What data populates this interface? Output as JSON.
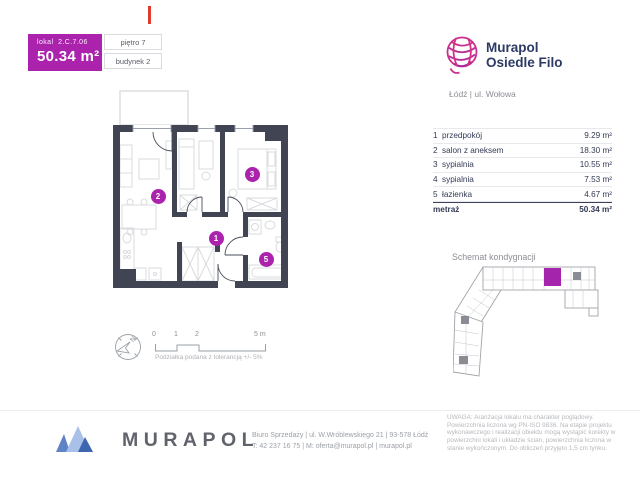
{
  "unit_card": {
    "label": "lokal",
    "number": "2.C.7.06",
    "area": "50.34 m²",
    "floor": "piętro 7",
    "building": "budynek 2"
  },
  "brand": {
    "line1": "Murapol",
    "line2": "Osiedle Filo",
    "location": "Łódź | ul. Wołowa"
  },
  "room_table": {
    "rows": [
      {
        "no": "1",
        "name": "przedpokój",
        "area": "9.29 m²"
      },
      {
        "no": "2",
        "name": "salon z aneksem",
        "area": "18.30 m²"
      },
      {
        "no": "3",
        "name": "sypialnia",
        "area": "10.55 m²"
      },
      {
        "no": "4",
        "name": "sypialnia",
        "area": "7.53 m²"
      },
      {
        "no": "5",
        "name": "łazienka",
        "area": "4.67 m²"
      }
    ],
    "total_label": "metraż",
    "total_area": "50.34 m²"
  },
  "schematic": {
    "title": "Schemat kondygnacji"
  },
  "plan": {
    "markers": {
      "m1": "1",
      "m2": "2",
      "m3": "3",
      "m5": "5"
    },
    "compass_n": "N",
    "scale": {
      "t0": "0",
      "t1": "1",
      "t2": "2",
      "t5": "5 m",
      "note": "Podziałka podana z tolerancją +/- 5%"
    }
  },
  "footer": {
    "wordmark": "MURAPOL",
    "address1": "Biuro Sprzedaży | ul. W.Wróblewskiego 21 | 93-578 Łódź",
    "address2": "T: 42 237 16 75 | M: oferta@murapol.pl | murapol.pl",
    "legal": "UWAGA: Aranżacja lokalu ma charakter poglądowy. Powierzchnia liczona wg PN-ISO 9836. Na etapie projektu wykonawczego i realizacji obiektu mogą wystąpić korekty w powierzchni lokali i układzie ścian, powierzchnia liczona w stanie wykończonym. Do obliczeń przyjęto 1,5 cm tynku."
  },
  "colors": {
    "accent": "#ab22ad",
    "navy": "#2e3a5c",
    "wall": "#414553",
    "gray": "#8b8e94"
  }
}
